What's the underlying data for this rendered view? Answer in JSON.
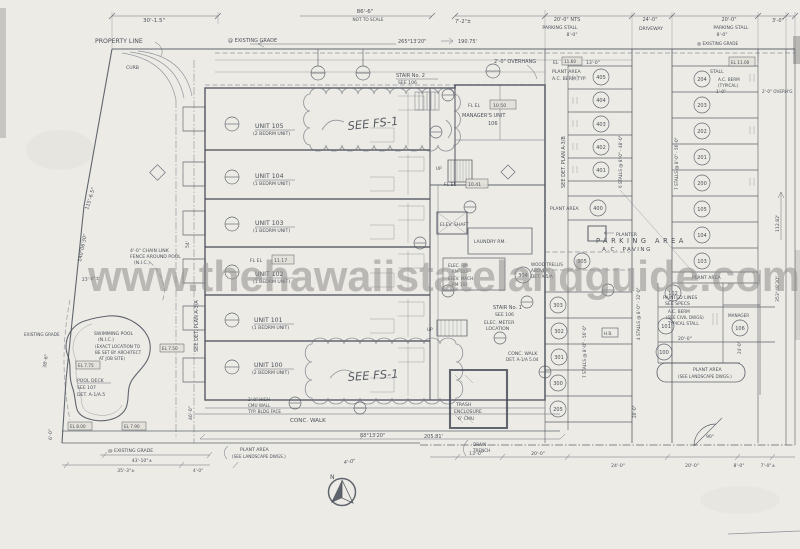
{
  "doc": {
    "watermark": "www.thehawaiistatelandguide.com"
  },
  "topdims": {
    "d30": "30'-1.5\"",
    "d86": "86'-6\"",
    "nts": "NOT TO SCALE",
    "brg": "265°13'20\"",
    "len": "190.75'",
    "d72": "7'-2\"±",
    "d20nts": "20'-0\" NTS",
    "pstall1": "PARKING STALL",
    "p8a": "8'-0\"",
    "d24": "24'-0\"",
    "drv": "DRIVEWAY",
    "d20b": "20'-0\"",
    "pstall2": "PARKING STALL",
    "p8b": "8'-0\"",
    "d3": "3'-0\"",
    "exgrade": "@ EXISTING GRADE",
    "exgrade2": "@ EXISTING GRADE",
    "propline": "PROPERTY LINE",
    "curb": "CURB"
  },
  "leftside": {
    "d115": "115'-6.5\"",
    "brg140": "140°06'30\"",
    "d54": "54'",
    "d38": "38'-6\"",
    "d6": "6'-0\"",
    "d23": "23'-0\"±",
    "exgrade": "EXISTING GRADE",
    "d46": "46'-0\"",
    "seedet": "SEE DET. PLAN A-3/A",
    "el775": "EL 7.75",
    "el750": "EL 7.50",
    "el800": "EL 8.00",
    "el790": "EL 7.90"
  },
  "units": [
    {
      "name": "UNIT 105",
      "type": "(2 BEDRM UNIT)"
    },
    {
      "name": "UNIT 104",
      "type": "(1 BEDRM UNIT)"
    },
    {
      "name": "UNIT 103",
      "type": "(1 BEDRM UNIT)"
    },
    {
      "name": "UNIT 102",
      "type": "(1 BEDRM UNIT)"
    },
    {
      "name": "UNIT 101",
      "type": "(1 BEDRM UNIT)"
    },
    {
      "name": "UNIT 100",
      "type": "(2 BEDRM UNIT)"
    }
  ],
  "core": {
    "stair2a": "STAIR No. 2",
    "stair2b": "SEE 106",
    "stair1a": "STAIR No. 1",
    "stair1b": "SEE 106",
    "mgrel": "FL EL",
    "mgrelv": "10.50",
    "mgr1": "MANAGER'S UNIT",
    "mgr2": "106",
    "fl1117l": "FL EL",
    "fl1117v": "11.17",
    "fl1041l": "FL EL",
    "fl1041v": "10.41",
    "laundry": "LAUNDRY RM.",
    "elevshaft": "ELEV. SHAFT",
    "elecrm1": "ELEC. RM",
    "elecrm2": "RM 103",
    "elevmach1": "ELEV. MACH.",
    "elevmach2": "RM 102",
    "trellis1": "WOOD TRELLIS",
    "trellis2": "ABOVE",
    "trellis3": "DET. A-5/A",
    "meter1": "ELEC. METER",
    "meter2": "LOCATION",
    "up1": "UP",
    "up2": "UP",
    "fs1a": "SEE FS-1",
    "fs1b": "SEE FS-1",
    "ovh": "2'-0\" OVERHANG",
    "el1160": "EL",
    "el1160v": "11.60",
    "d13": "13'-0\""
  },
  "parking": {
    "area": "PARKING AREA",
    "paving": "A.C. PAVING",
    "planter": "PLANTER",
    "plantA1": "PLANT AREA",
    "plantA2": "A.C. BERM TYP",
    "plantA3": "PLANT AREA",
    "plantB": "PLANT AREA",
    "stallword": "STALL",
    "berm1": "A.C. BERM",
    "berm2": "(TYPICAL)",
    "berm3": "1'-0\"",
    "el1100": "EL 11.00",
    "painted1": "PAINTED LINES",
    "painted2": "SEE SPECS",
    "bermcivil1": "A.C. BERM",
    "bermcivil2": "(SEE CIVIL DWGS)",
    "bermcivil3": "TYPICAL STALL",
    "mgr": "MANAGER",
    "d20": "20'-0\"",
    "hb": "H.B.",
    "v6stalls": "6 STALLS @ 8'-0\" - 48'-0\"",
    "v7stalls": "7 STALLS @ 8'-0\" - 56'-0\"",
    "v7stallsB": "7 STALLS @ 8'-0\" - 56'-0\"",
    "v4stalls": "4 STALLS @ 8'-0\" - 32'-0\"",
    "v20": "20'-0\"",
    "v24": "24'-0\"",
    "plantRect1": "PLANT AREA",
    "plantRect2": "(SEE LANDSCAPE DWGS.)",
    "stallsA": [
      "405",
      "404",
      "403",
      "402",
      "401",
      "400"
    ],
    "stallsB": [
      "204",
      "203",
      "202",
      "201",
      "200",
      "105",
      "104",
      "103"
    ],
    "stallsB2": [
      "102",
      "101",
      "100"
    ],
    "mgrnum": "106",
    "stallsC": [
      "305",
      "304",
      "303",
      "302",
      "301",
      "300",
      "205"
    ],
    "ovhr": "2'-0\" OVERH'G"
  },
  "rightside": {
    "brg353": "353°48'30\"",
    "len112": "112.82'",
    "seedet": "SEE DET. PLAN A-3/B"
  },
  "pool": {
    "l1": "SWIMMING POOL",
    "l2": "(N.I.C.)",
    "l3": "(EXACT LOCATION TO",
    "l4": "BE SET BY ARCHITECT",
    "l5": "AT JOB SITE)",
    "deck1": "POOL DECK",
    "deck2": "SEE 107",
    "deck3": "DET. A-1/A.5",
    "fence1": "4'-0\" CHAIN LINK",
    "fence2": "FENCE AROUND POOL",
    "fence3": "(N.I.C.)"
  },
  "bottom": {
    "conc1": "CONC. WALK",
    "conc2": "CONC. WALK",
    "concdet": "DET. A-1/A 5.04",
    "cmu1": "2'-0\" HIGH",
    "cmu2": "CMU WALL",
    "cmu3": "TYP. BLDG FACE",
    "trash1": "TRASH",
    "trash2": "ENCLOSURE",
    "trash3": "6' CMU",
    "drain1": "DRAIN",
    "drain2": "TRENCH",
    "brg83": "83°13'20\"",
    "len205": "205.81'",
    "plant1": "PLANT AREA",
    "plant2": "(SEE LANDSCAPE DWGS.)",
    "d440": "4'-0\"",
    "north": "N",
    "deg90": "90°",
    "exgrade": "@ EXISTING GRADE",
    "d43": "43'-10\"±",
    "d35": "35'-3\"±",
    "d4": "4'-0\"",
    "d13": "13'-0\"",
    "d20": "20'-0\"",
    "d24": "24'-0\"",
    "d20b": "20'-0\"",
    "d8": "8'-0\"",
    "d7": "7'-0\"±"
  }
}
